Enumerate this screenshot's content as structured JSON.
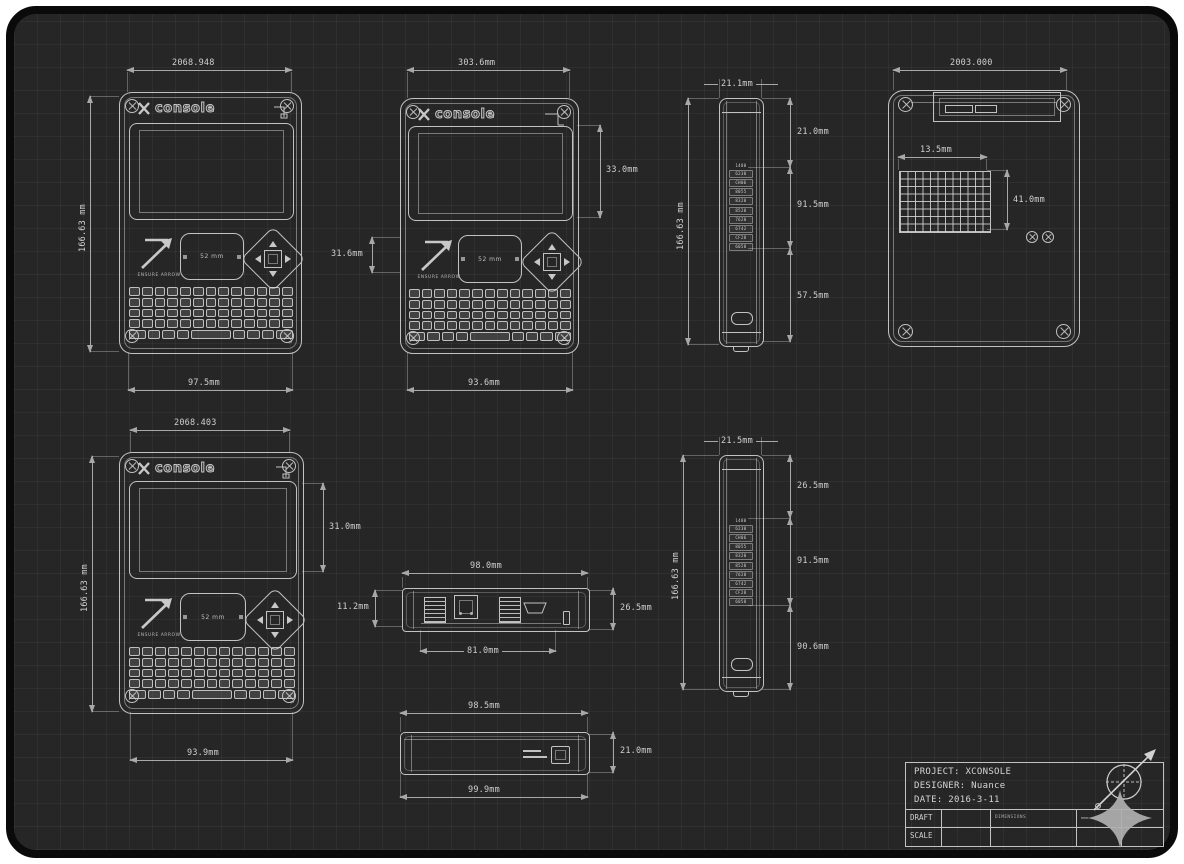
{
  "colors": {
    "sheet_background": "#262626",
    "line": "#c2c2c2",
    "dimension_line": "#a8a8a8",
    "dimension_text": "#cfcfcf",
    "star_logo": "#b0b0b0"
  },
  "logo": {
    "mark": "X",
    "word": "console"
  },
  "arrow_caption": "ENSURE ARROW",
  "trackpad_label": "52 mm",
  "keyboard": {
    "rows": [
      13,
      13,
      13,
      13,
      9
    ],
    "corner_mark": "↵"
  },
  "side_port_labels": [
    "1480",
    "6230",
    "CH06",
    "8055",
    "8320",
    "8520",
    "7620",
    "6742",
    "CF28",
    "6058"
  ],
  "vent_grid": {
    "cols": 12,
    "rows": 8
  },
  "dims": {
    "v1_top": "2068.948",
    "v1_left": "166.63 mm",
    "v1_bottom": "97.5mm",
    "v2_top": "303.6mm",
    "v2_screen": "33.0mm",
    "v2_trackpad": "31.6mm",
    "v2_bottom": "93.6mm",
    "v3_top": "21.1mm",
    "v3_left": "166.63 mm",
    "v3_seg1": "21.0mm",
    "v3_seg2": "91.5mm",
    "v3_seg3": "57.5mm",
    "v4_top": "2003.000",
    "v4_vent_w": "13.5mm",
    "v4_vent_h": "41.0mm",
    "v5_top": "2068.403",
    "v5_left": "166.63 mm",
    "v5_screen": "31.0mm",
    "v5_bottom": "93.9mm",
    "v6_top": "98.0mm",
    "v6_left": "11.2mm",
    "v6_right": "26.5mm",
    "v6_bottom": "81.0mm",
    "v7_top": "98.5mm",
    "v7_right": "21.0mm",
    "v7_bottom": "99.9mm",
    "v8_top": "21.5mm",
    "v8_left": "166.63 mm",
    "v8_seg1": "26.5mm",
    "v8_seg2": "91.5mm",
    "v8_seg3": "90.6mm"
  },
  "title_block": {
    "project": "PROJECT: XCONSOLE",
    "designer": "DESIGNER: Nuance",
    "date": "DATE: 2016-3-11",
    "row1_label": "DRAFT",
    "row2_label": "SCALE",
    "row1_note": "DIMENSIONS",
    "row1_mark1": "▬▬▬",
    "row1_mark2": "▬▬"
  }
}
